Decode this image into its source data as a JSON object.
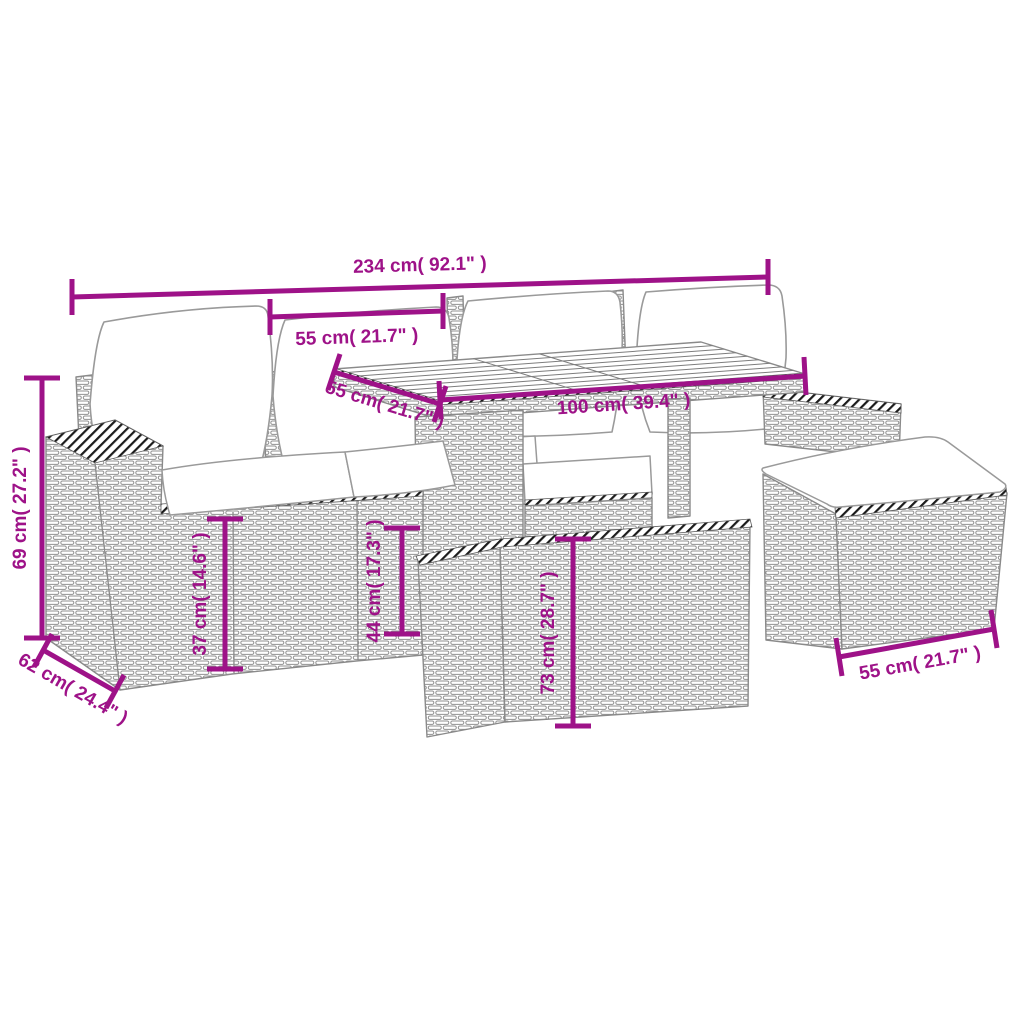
{
  "diagram": {
    "description": "Garden lounge set line drawing with dimension annotations",
    "accent_color": "#9E1288",
    "line_art_color": "#8a8a8a",
    "labels": {
      "total_width": "234 cm( 92.1\" )",
      "seat_width": "55 cm( 21.7\" )",
      "table_side": "55 cm( 21.7\" )",
      "table_length": "100 cm( 39.4\" )",
      "back_height": "69 cm( 27.2\" )",
      "seat_height": "37 cm( 14.6\" )",
      "section_height": "44 cm( 17.3\" )",
      "table_height": "73 cm( 28.7\" )",
      "depth": "62 cm( 24.4\" )",
      "stool_width": "55 cm( 21.7\" )"
    }
  }
}
